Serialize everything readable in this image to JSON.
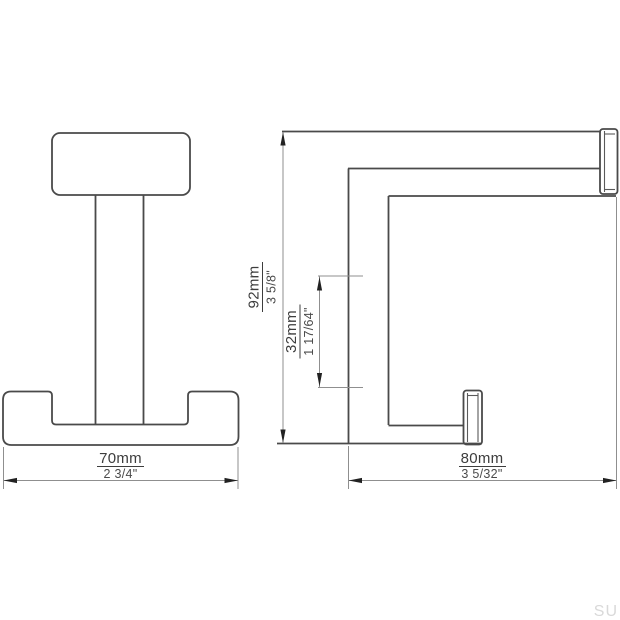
{
  "drawing": {
    "dims": {
      "width": {
        "mm": "70mm",
        "inch": "2 3/4\""
      },
      "height": {
        "mm": "92mm",
        "inch": "3 5/8\""
      },
      "spacing": {
        "mm": "32mm",
        "inch": "1 17/64\""
      },
      "depth": {
        "mm": "80mm",
        "inch": "3 5/32\""
      }
    },
    "watermark": "SU",
    "colors": {
      "outline": "#4a4a4a",
      "dimension_line": "#8f8f8f",
      "arrowhead": "#222222",
      "text": "#3d3d3d",
      "watermark": "#d9d9d9",
      "background": "#ffffff"
    }
  }
}
